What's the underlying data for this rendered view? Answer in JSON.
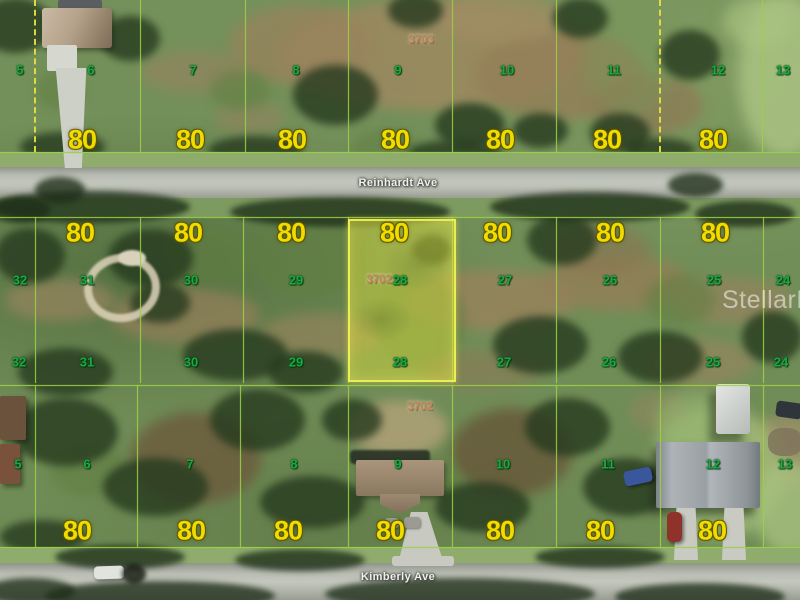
{
  "map": {
    "watermark": "StellarMLS",
    "roads": [
      {
        "name": "Reinhardt Ave"
      },
      {
        "name": "Kimberly Ave"
      }
    ],
    "highlight": {
      "parcel_id": "3702",
      "lot": "28"
    },
    "blocks": [
      {
        "id": "north",
        "parcel_id": "3703",
        "lot_numbers": [
          "5",
          "6",
          "7",
          "8",
          "9",
          "10",
          "11",
          "12",
          "13"
        ],
        "dimensions": [
          "80",
          "80",
          "80",
          "80",
          "80",
          "80",
          "80"
        ]
      },
      {
        "id": "central",
        "parcel_id": "3702",
        "lot_numbers": [
          "32",
          "31",
          "30",
          "29",
          "28",
          "27",
          "26",
          "25",
          "24"
        ],
        "dimensions": [
          "80",
          "80",
          "80",
          "80",
          "80",
          "80",
          "80"
        ]
      },
      {
        "id": "south",
        "parcel_id": "3702",
        "lot_numbers": [
          "5",
          "6",
          "7",
          "8",
          "9",
          "10",
          "11",
          "12",
          "13"
        ],
        "dimensions": [
          "80",
          "80",
          "80",
          "80",
          "80",
          "80",
          "80"
        ]
      }
    ],
    "colors": {
      "lot_number": "#1ca844",
      "dimension": "#f2dc00",
      "parcel_id": "#c08a52",
      "boundary": "rgba(158,209,68,0.85)",
      "boundary_dash": "#e6df3e",
      "highlight_fill": "rgba(226,228,62,0.45)",
      "highlight_border": "rgba(240,240,85,0.95)",
      "road_label": "#eff1eb",
      "watermark": "rgba(255,255,255,0.52)"
    }
  }
}
